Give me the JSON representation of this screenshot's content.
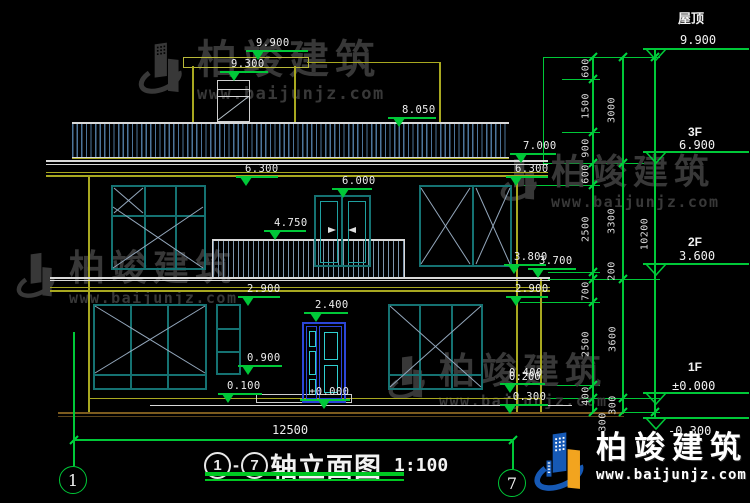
{
  "drawing_title": {
    "axis_start": "1",
    "dash": "-",
    "axis_end": "7",
    "name": "轴立面图",
    "scale": "1:100"
  },
  "axis_bubbles": {
    "left": "1",
    "right": "7"
  },
  "overall_dim": "12500",
  "floor_levels": [
    {
      "label": "屋顶",
      "value": "9.900"
    },
    {
      "label": "3F",
      "value": "6.900"
    },
    {
      "label": "2F",
      "value": "3.600"
    },
    {
      "label": "1F",
      "value": "±0.000"
    },
    {
      "label": "",
      "value": "-0.300"
    }
  ],
  "spot_levels": [
    "9.900",
    "9.300",
    "8.050",
    "7.000",
    "6.300",
    "6.300",
    "6.000",
    "4.750",
    "3.800",
    "3.700",
    "2.900",
    "2.900",
    "2.400",
    "0.900",
    "0.100",
    "±0.000",
    "0.400",
    "0.200",
    "-0.300"
  ],
  "dims_inner": [
    "600",
    "1500",
    "900",
    "600",
    "2500",
    "200",
    "700",
    "2500",
    "400",
    "300"
  ],
  "dims_mid": [
    "3000",
    "3300",
    "3600",
    "300"
  ],
  "dims_total": "10200",
  "watermark": {
    "brand": "柏竣建筑",
    "url": "www.baijunjz.com"
  },
  "brand_logo": {
    "brand": "柏竣建筑",
    "url": "www.baijunjz.com"
  },
  "colors": {
    "dim_green": "#00c838",
    "cad_yellow": "#a8a820",
    "frame_teal": "#157272",
    "roof_blue": "#4d7499",
    "door_blue": "#2b46d8",
    "panel_cyan": "#2fd0d0",
    "ground_brown": "#7c5b1e",
    "watermark_gray": "#3c3c3c",
    "logo_blue": "#1659b5",
    "logo_orange": "#f2a41f"
  }
}
